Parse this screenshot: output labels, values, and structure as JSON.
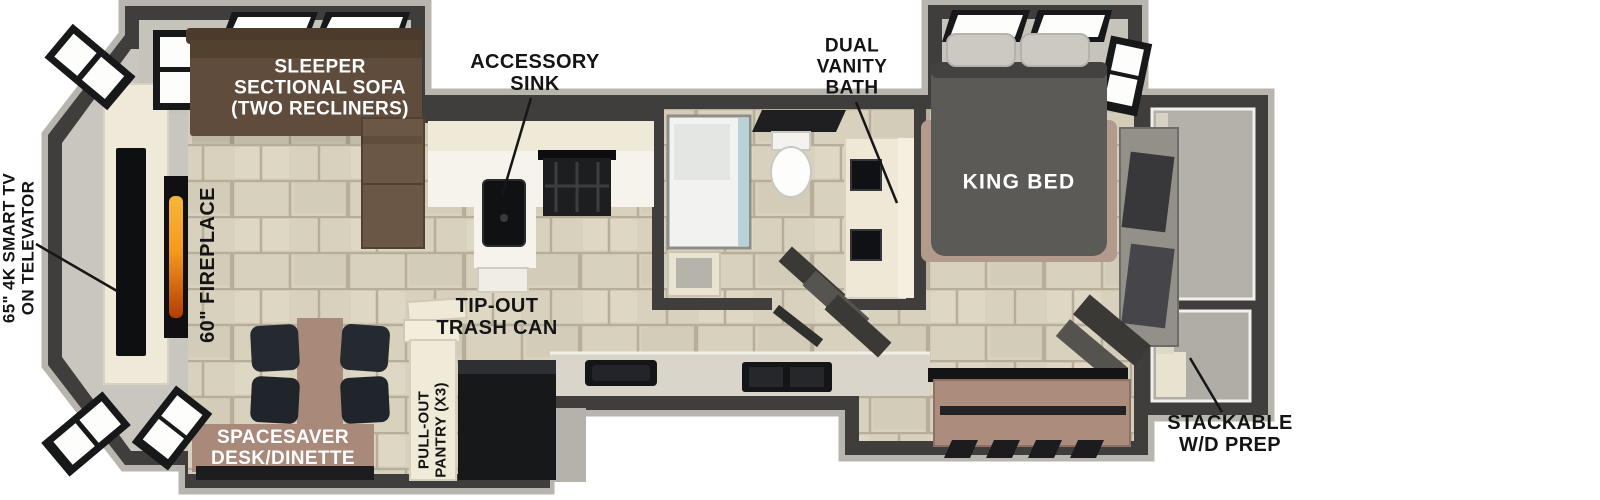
{
  "diagram_type": "rv-floorplan",
  "labels": {
    "tv": {
      "line1": "65\" 4K SMART TV",
      "line2": "ON TELEVATOR"
    },
    "fireplace": "60\" FIREPLACE",
    "sofa": {
      "line1": "SLEEPER",
      "line2": "SECTIONAL SOFA",
      "line3": "(TWO RECLINERS)"
    },
    "accessory_sink": {
      "line1": "ACCESSORY",
      "line2": "SINK"
    },
    "dual_vanity": {
      "line1": "DUAL",
      "line2": "VANITY",
      "line3": "BATH"
    },
    "king_bed": "KING BED",
    "trash_can": {
      "line1": "TIP-OUT",
      "line2": "TRASH CAN"
    },
    "desk": {
      "line1": "SPACESAVER",
      "line2": "DESK/DINETTE"
    },
    "pantry": {
      "line1": "PULL-OUT",
      "line2": "PANTRY (X3)"
    },
    "wd_prep": {
      "line1": "STACKABLE",
      "line2": "W/D PREP"
    }
  },
  "palette": {
    "wall_dark": "#3f3e3c",
    "trim_light": "#b8b5ae",
    "floor_tile": "#d7d1be",
    "tile_grout": "#b7ae99",
    "slide_floor": "#c6c3bb",
    "counter_cream": "#efe9d7",
    "sofa_brown": "#5f4c3c",
    "desk_mauve": "#a8897a",
    "bed_gray": "#5b5a56",
    "bed_base": "#b29a8c",
    "pillow": "#ccc9c3",
    "appliance_black": "#141517",
    "flame_orange": "#f59a1e",
    "label_dark": "#141414",
    "label_white": "#ffffff"
  }
}
